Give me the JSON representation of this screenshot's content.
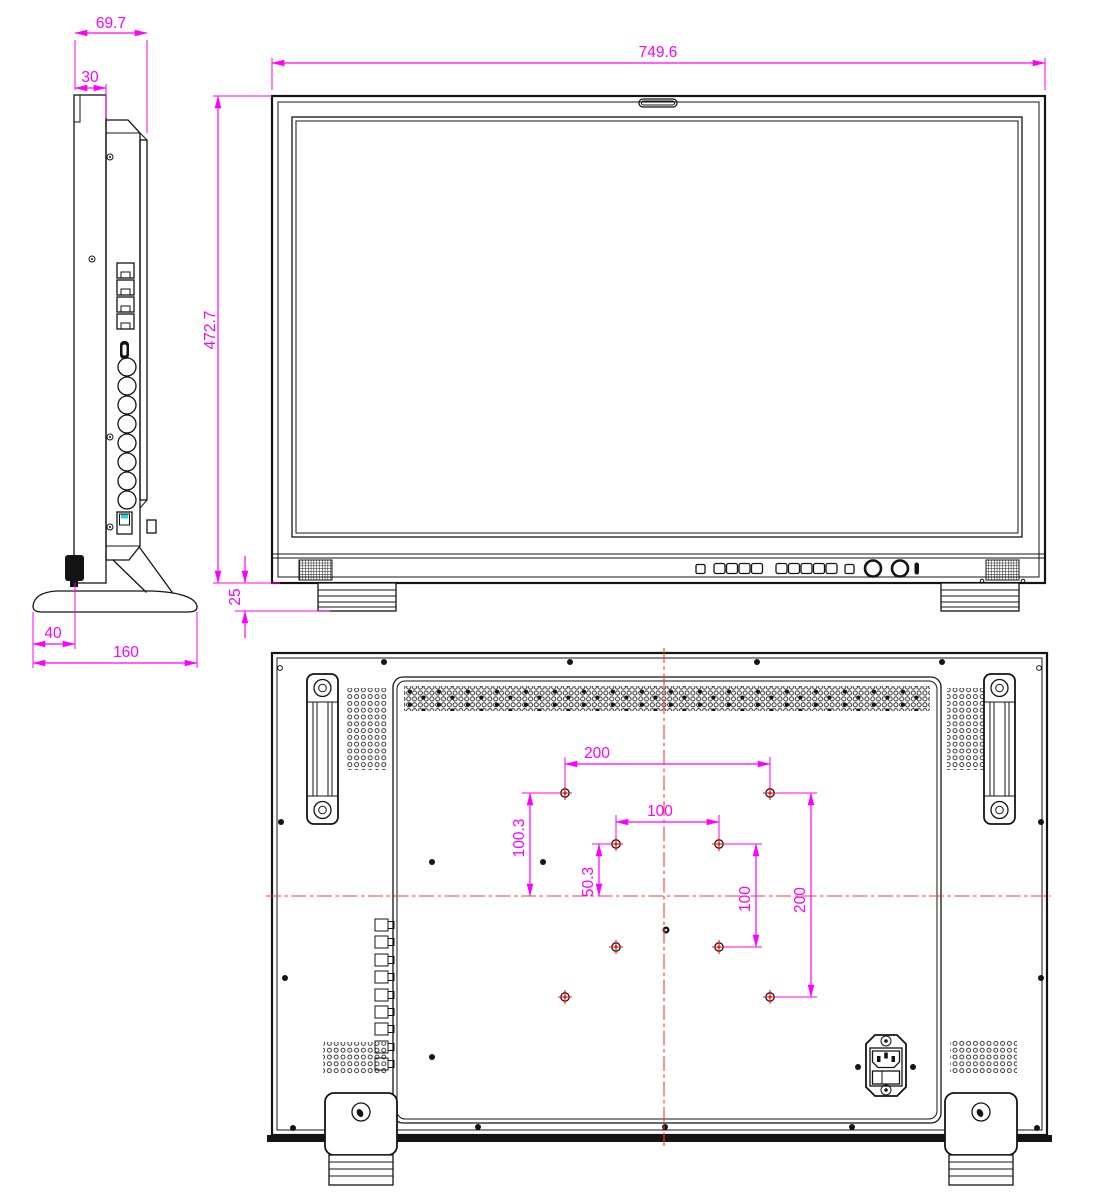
{
  "drawing": {
    "title": "Monitor outline dimension drawing (side / front / rear views)",
    "units": "mm",
    "colors": {
      "outline": "#141414",
      "dimension": "#ff00ff",
      "centerline": "#ff3b30",
      "vesa_marker": "#ff1111",
      "switch_detail": "#2ad4d4"
    },
    "side_view": {
      "dims": {
        "total_depth": "69.7",
        "front_depth": "30",
        "base_front_offset": "40",
        "base_depth": "160"
      }
    },
    "front_view": {
      "dims": {
        "overall_width": "749.6",
        "overall_height": "472.7",
        "foot_height": "25"
      }
    },
    "rear_view": {
      "dims": {
        "vesa_h_200": "200",
        "vesa_h_100": "100",
        "vesa_offset_100_3": "100.3",
        "vesa_offset_50_3": "50.3",
        "vesa_v_100": "100",
        "vesa_v_200": "200"
      }
    }
  }
}
